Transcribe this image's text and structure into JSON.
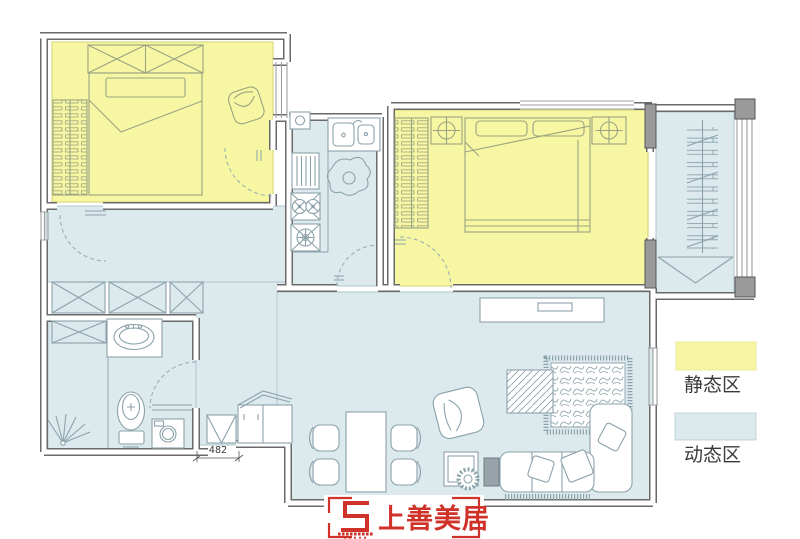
{
  "colors": {
    "static_zone": "#f7f7a3",
    "static_zone_border": "#d9d97e",
    "dynamic_zone": "#dceaed",
    "dynamic_zone_border": "#aec7ce",
    "wall": "#6a6a6a",
    "furniture_blue": "#8ba2ab",
    "furniture_olive": "#9aa382",
    "logo_red": "#cf3229",
    "text": "#3a3a3a"
  },
  "legend": {
    "items": [
      {
        "id": "static",
        "label": "静态区",
        "color": "#f7f7a3"
      },
      {
        "id": "dynamic",
        "label": "动态区",
        "color": "#dceaed"
      }
    ]
  },
  "dimension": {
    "value": "482"
  },
  "logo": {
    "text": "上善美居"
  },
  "zones": {
    "static": [
      "bedroom-1",
      "master-bedroom"
    ],
    "dynamic": [
      "kitchen",
      "hallway",
      "entry",
      "bathroom",
      "living-dining-room",
      "balcony"
    ]
  }
}
